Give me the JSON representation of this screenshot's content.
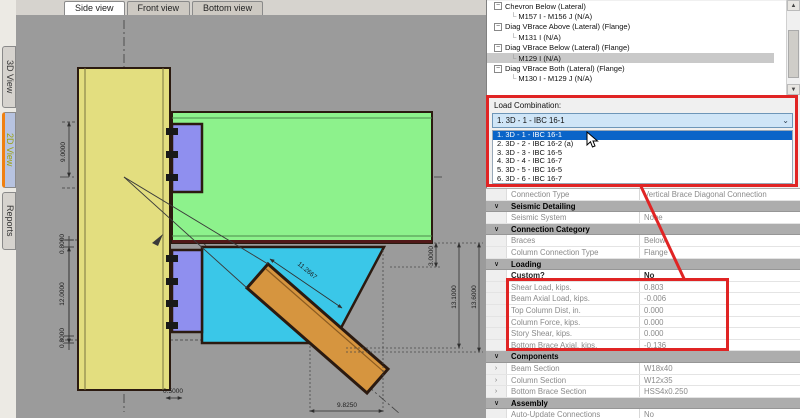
{
  "view_tabs": [
    {
      "label": "Side view",
      "active": true
    },
    {
      "label": "Front view",
      "active": false
    },
    {
      "label": "Bottom view",
      "active": false
    }
  ],
  "side_tabs": [
    {
      "label": "3D View",
      "active": false
    },
    {
      "label": "2D View",
      "active": true
    },
    {
      "label": "Reports",
      "active": false
    }
  ],
  "drawing": {
    "dims": {
      "left_height": "9.0000",
      "left_offset_top": "0.8000",
      "left_gusset_height": "12.0000",
      "left_offset_bottom": "0.8000",
      "base_setback": "0.5000",
      "bottom_width": "9.8250",
      "brace_length": "11.2667",
      "right_small": "3.0000",
      "right_inner": "13.1000",
      "right_outer": "13.6000"
    },
    "colors": {
      "canvas": "#9b9b9b",
      "column": "#e3de7f",
      "beam": "#8df28c",
      "plate": "#8f8fef",
      "gusset": "#3ac7e8",
      "brace": "#d6953f",
      "outline": "#2b1a10",
      "annotation_red": "#e02424",
      "selection_blue": "#0a64c8"
    }
  },
  "tree": {
    "items": [
      {
        "label": "Chevron Below (Lateral)",
        "children": [
          {
            "label": "M157 I - M156 J  (N/A)",
            "selected": false
          }
        ]
      },
      {
        "label": "Diag VBrace Above (Lateral) (Flange)",
        "children": [
          {
            "label": "M131 I  (N/A)",
            "selected": false
          }
        ]
      },
      {
        "label": "Diag VBrace Below (Lateral) (Flange)",
        "children": [
          {
            "label": "M129 I  (N/A)",
            "selected": true
          }
        ]
      },
      {
        "label": "Diag VBrace Both (Lateral) (Flange)",
        "children": [
          {
            "label": "M130 I - M129 J  (N/A)",
            "selected": false
          }
        ]
      }
    ]
  },
  "load_combination": {
    "label": "Load Combination:",
    "selected": "1. 3D - 1 - IBC 16-1",
    "options": [
      "1. 3D - 1 - IBC 16-1",
      "2. 3D - 2 - IBC 16-2 (a)",
      "3. 3D - 3 - IBC 16-5",
      "4. 3D - 4 - IBC 16-7",
      "5. 3D - 5 - IBC 16-5",
      "6. 3D - 6 - IBC 16-7"
    ]
  },
  "properties": {
    "rows": [
      {
        "type": "row",
        "name": "Connection Type",
        "value": "Vertical Brace Diagonal Connection"
      },
      {
        "type": "section",
        "name": "Seismic Detailing"
      },
      {
        "type": "row",
        "name": "Seismic System",
        "value": "None"
      },
      {
        "type": "section",
        "name": "Connection Category"
      },
      {
        "type": "row",
        "name": "Braces",
        "value": "Below"
      },
      {
        "type": "row",
        "name": "Column Connection Type",
        "value": "Flange"
      },
      {
        "type": "section",
        "name": "Loading"
      },
      {
        "type": "row",
        "name": "Custom?",
        "value": "No",
        "bold": true
      },
      {
        "type": "row",
        "name": "Shear Load, kips.",
        "value": "0.803"
      },
      {
        "type": "row",
        "name": "Beam Axial Load, kips.",
        "value": "-0.006"
      },
      {
        "type": "row",
        "name": "Top Column Dist, in.",
        "value": "0.000"
      },
      {
        "type": "row",
        "name": "Column Force, kips.",
        "value": "0.000"
      },
      {
        "type": "row",
        "name": "Story Shear, kips.",
        "value": "0.000"
      },
      {
        "type": "row",
        "name": "Bottom Brace Axial, kips.",
        "value": "-0.136"
      },
      {
        "type": "section",
        "name": "Components"
      },
      {
        "type": "row",
        "name": "Beam Section",
        "value": "W18x40",
        "expander": true
      },
      {
        "type": "row",
        "name": "Column Section",
        "value": "W12x35",
        "expander": true
      },
      {
        "type": "row",
        "name": "Bottom Brace Section",
        "value": "HSS4x0.250",
        "expander": true
      },
      {
        "type": "section",
        "name": "Assembly"
      },
      {
        "type": "row",
        "name": "Auto-Update Connections",
        "value": "No"
      }
    ]
  }
}
